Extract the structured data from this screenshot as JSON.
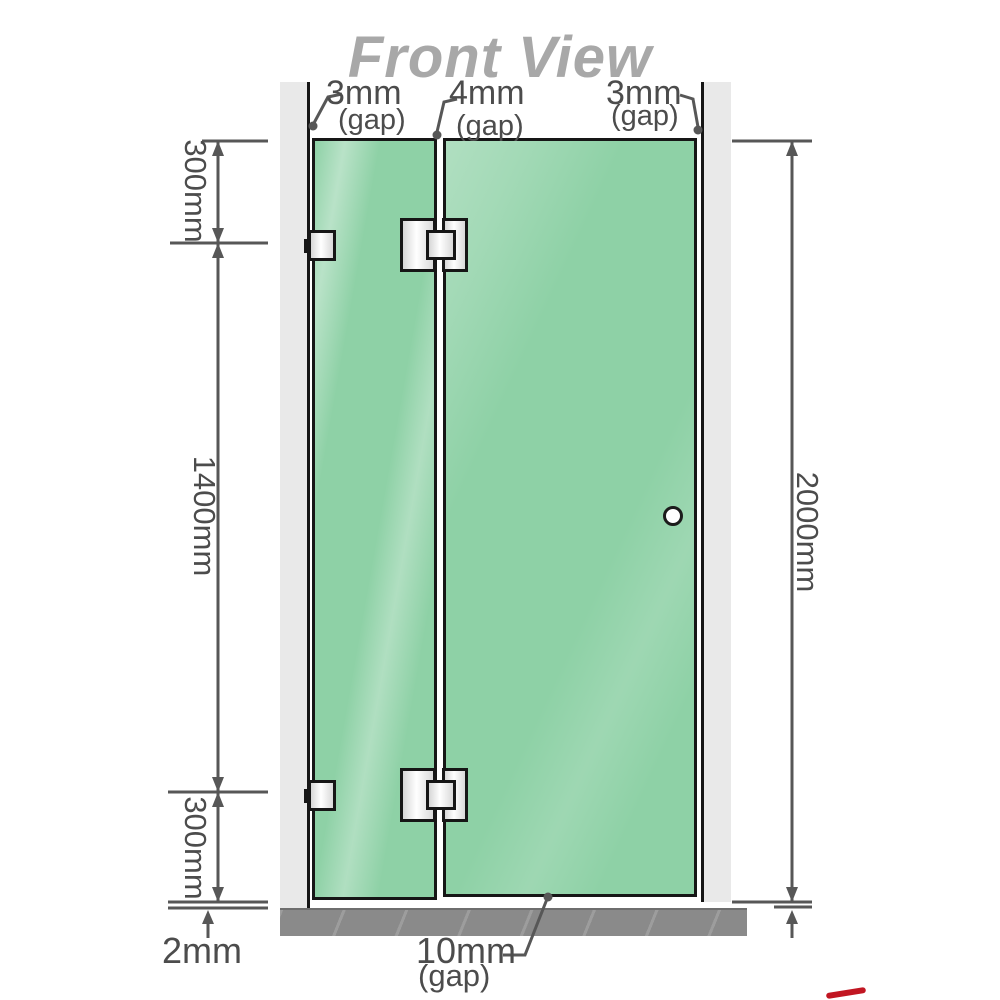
{
  "title": "Front View",
  "gaps": {
    "left": {
      "value": "3mm",
      "note": "(gap)"
    },
    "middle": {
      "value": "4mm",
      "note": "(gap)"
    },
    "right": {
      "value": "3mm",
      "note": "(gap)"
    },
    "bottom": {
      "value": "10mm",
      "note": "(gap)"
    }
  },
  "heights": {
    "top_section": "300mm",
    "middle_section": "1400mm",
    "bottom_section": "300mm",
    "total": "2000mm",
    "floor_clearance": "2mm"
  },
  "colors": {
    "glass": "#8ed1a6",
    "wall": "#e9e9e9",
    "floor": "#8a8a8a",
    "line": "#575757",
    "label": "#4c4c4c",
    "title": "#a8a8a8",
    "edge": "#161616",
    "red_mark": "#c11622"
  }
}
